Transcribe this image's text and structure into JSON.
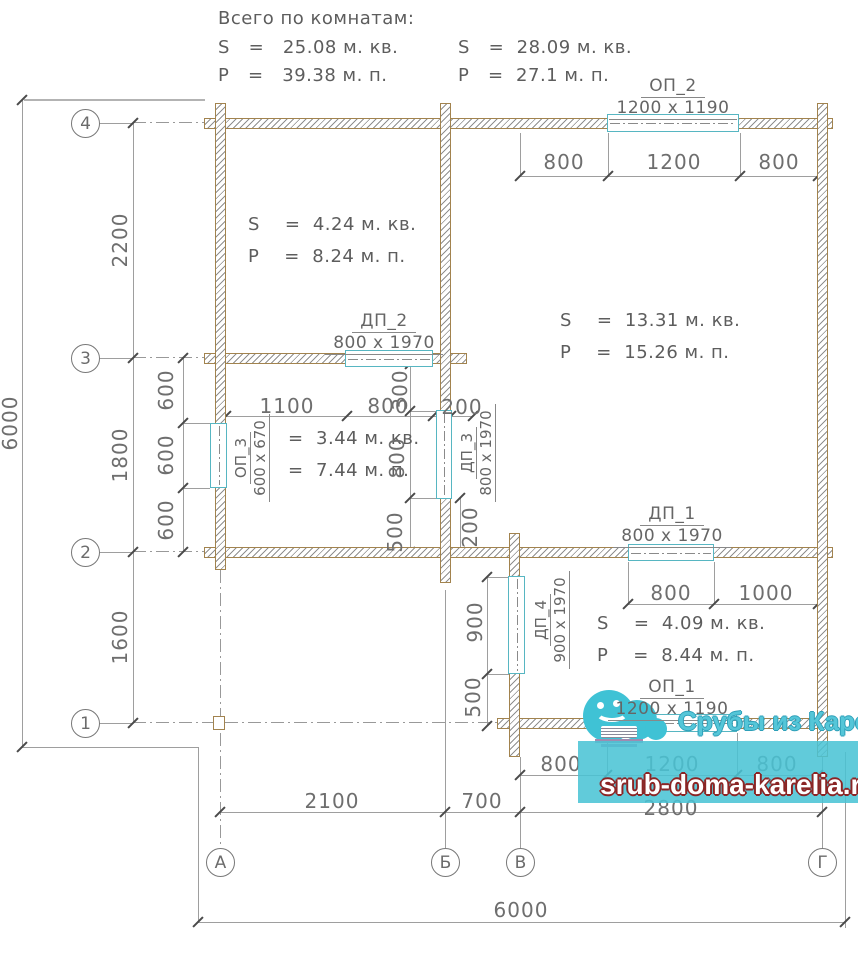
{
  "header": {
    "title": "Всего по комнатам:",
    "total1_s": "S   =   25.08 м. кв.",
    "total1_p": "P   =   39.38 м. п.",
    "total2_s": "S   =  28.09 м. кв.",
    "total2_p": "P   =  27.1 м. п."
  },
  "rooms": {
    "r1_s": "S    =  4.24 м. кв.",
    "r1_p": "P    =  8.24 м. п.",
    "r2_s": "S    =  13.31 м. кв.",
    "r2_p": "P    =  15.26 м. п.",
    "r3_s": "=  3.44 м. кв.",
    "r3_p": "=  7.44 м. п.",
    "r4_s": "S    =  4.09 м. кв.",
    "r4_p": "P    =  8.44 м. п."
  },
  "openings": {
    "op2_name": "ОП_2",
    "op2_size": "1200 x 1190",
    "dp2_name": "ДП_2",
    "dp2_size": "800 x 1970",
    "op3_name": "ОП_3",
    "op3_size": "600 x 670",
    "dp3_name": "ДП_3",
    "dp3_size": "800 x 1970",
    "dp1_name": "ДП_1",
    "dp1_size": "800 x 1970",
    "dp4_name": "ДП_4",
    "dp4_size": "900 x 1970",
    "op1_name": "ОП_1",
    "op1_size": "1200 x 1190"
  },
  "dims": {
    "top_800a": "800",
    "top_1200": "1200",
    "top_800b": "800",
    "left_2200": "2200",
    "left_1800": "1800",
    "left_1600": "1600",
    "left_6000": "6000",
    "win600_a": "600",
    "win600_b": "600",
    "win600_c": "600",
    "mid_1100": "1100",
    "mid_800": "800",
    "mid_300": "300",
    "mid_200": "200",
    "db_800": "800",
    "db_500": "500",
    "db_200": "200",
    "dp4_900": "900",
    "dp4_500": "500",
    "dp1_800": "800",
    "dp1_1000": "1000",
    "bw_800a": "800",
    "bw_1200": "1200",
    "bw_800b": "800",
    "row_2100": "2100",
    "row_700": "700",
    "row_2800": "2800",
    "total_6000": "6000"
  },
  "axes": {
    "r4": "4",
    "r3": "3",
    "r2": "2",
    "r1": "1",
    "ca": "А",
    "cb": "Б",
    "cv": "В",
    "cg": "Г"
  },
  "watermark": {
    "brand": "Срубы из Карелии",
    "url": "srub-doma-karelia.ru",
    "teal": "#3fc2d5",
    "url_outline": "#8b2525"
  },
  "colors": {
    "wall_outline": "#a2834e",
    "window_accent": "#57b6c2"
  }
}
